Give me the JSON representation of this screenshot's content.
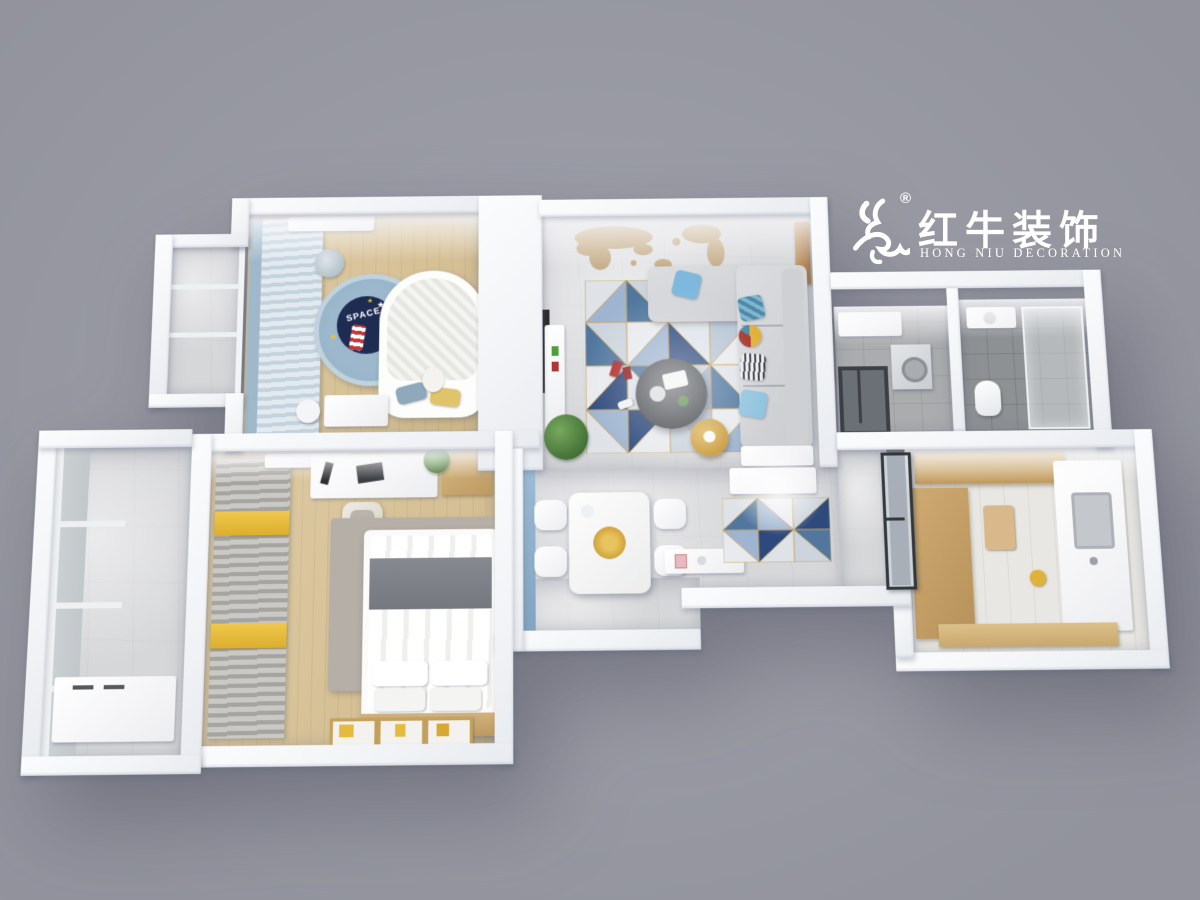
{
  "logo": {
    "icon": "bull-icon",
    "registered_mark": "®",
    "brand_cn": "红牛装饰",
    "brand_en": "HONG NIU DECORATION"
  },
  "decor_text": {
    "kids_rug": "SPACE"
  },
  "palette": {
    "background": "#9a9ba5",
    "wall_white": "#f6f7f9",
    "wood_floor": "#d8c39c",
    "marble_floor": "#d6d7d9",
    "bath_tile_dark": "#8e9194",
    "laundry_tile": "#aaacae",
    "kitchen_floor": "#e9e7e3",
    "blue_accent_wall": "#8fb0cc",
    "kids_curtain_blue": "#9fb9cb",
    "master_curtain_gray": "#a6a49f",
    "curtain_yellow": "#e3b93a",
    "kids_rug_outer": "#8fb0c9",
    "kids_rug_navy": "#1f2c52",
    "sofa_gray": "#d9dadc",
    "rug_blue": "#51779f",
    "rug_navy": "#2e4a7d",
    "rug_gold_line": "#caa763",
    "coffee_table_dark": "#53565b",
    "side_table_gold": "#d2a84c",
    "wood_cabinet": "#c9a86b",
    "logo_white": "#ffffff"
  }
}
